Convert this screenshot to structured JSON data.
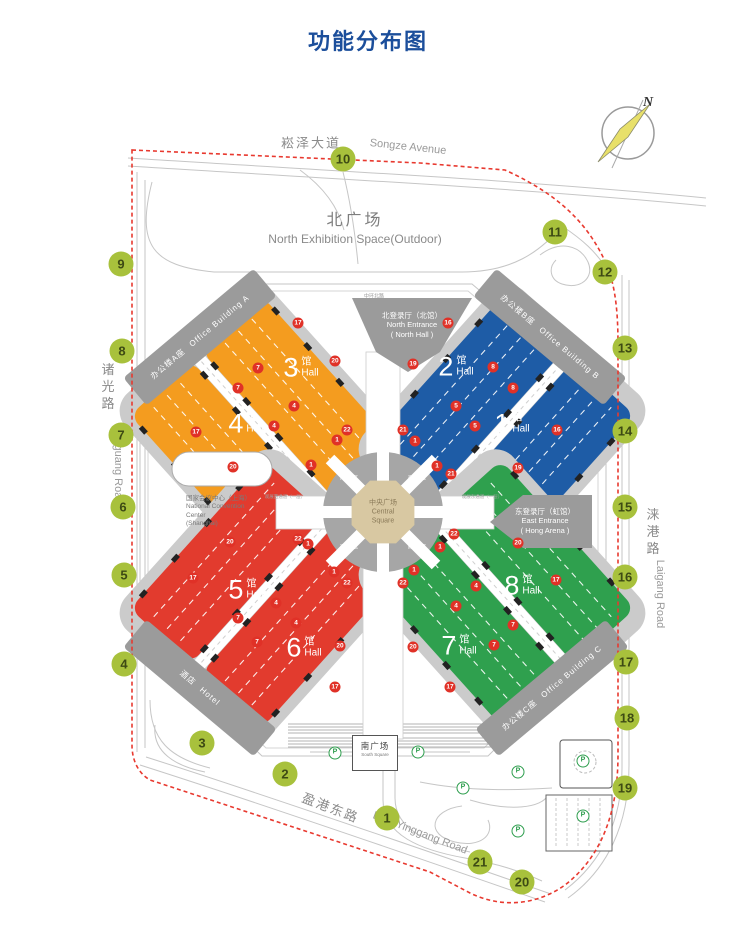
{
  "title": "功能分布图",
  "compass": {
    "label": "N"
  },
  "roads": {
    "songze_cn": "崧泽大道",
    "songze_en": "Songze Avenue",
    "zhuguang_cn": "诸光路",
    "zhuguang_en": "Zhuguang Road",
    "laigang_cn": "涞港路",
    "laigang_en": "Laigang Road",
    "yinggang_cn": "盈港东路",
    "yinggang_en": "East Yinggang Road",
    "zhonghuan_north": "中环北路",
    "corridor_west": "观展西通道（一层）",
    "corridor_east": "观展东通道（一层）"
  },
  "areas": {
    "north_plaza_cn": "北广场",
    "north_plaza_en": "North Exhibition Space(Outdoor)",
    "south_plaza_cn": "南广场",
    "south_plaza_en": "South Square",
    "central_cn": "中央广场",
    "central_en1": "Central",
    "central_en2": "Square",
    "north_entrance_cn": "北登录厅（北馆）",
    "north_entrance_en1": "North Entrance",
    "north_entrance_en2": "( North Hall )",
    "east_entrance_cn": "东登录厅（虹馆）",
    "east_entrance_en1": "East Entrance",
    "east_entrance_en2": "( Hong Arena )",
    "ncc_cn": "国家会议中心（上海）",
    "ncc_en1": "National Convention",
    "ncc_en2": "Center",
    "ncc_en3": "(Shanghai)",
    "office_a_cn": "办公楼A座",
    "office_a_en": "Office Building A",
    "office_b_cn": "办公楼B座",
    "office_b_en": "Office Building B",
    "office_c_cn": "办公楼C座",
    "office_c_en": "Office Building C",
    "hotel_cn": "酒店",
    "hotel_en": "Hotel",
    "plaza_a": "商业A区",
    "plaza_b": "商业B区",
    "plaza_c": "商业C区",
    "plaza_d": "商业D区"
  },
  "halls": [
    {
      "num": "1",
      "suffix": "馆",
      "sub": "Hall"
    },
    {
      "num": "2",
      "suffix": "馆",
      "sub": "Hall"
    },
    {
      "num": "3",
      "suffix": "馆",
      "sub": "Hall"
    },
    {
      "num": "4",
      "suffix": "馆",
      "sub": "Hall"
    },
    {
      "num": "5",
      "suffix": "馆",
      "sub": "Hall"
    },
    {
      "num": "6",
      "suffix": "馆",
      "sub": "Hall"
    },
    {
      "num": "7",
      "suffix": "馆",
      "sub": "Hall"
    },
    {
      "num": "8",
      "suffix": "馆",
      "sub": "Hall"
    }
  ],
  "markers": [
    {
      "label": "1",
      "x": 387,
      "y": 818
    },
    {
      "label": "2",
      "x": 285,
      "y": 774
    },
    {
      "label": "3",
      "x": 202,
      "y": 743
    },
    {
      "label": "4",
      "x": 124,
      "y": 664
    },
    {
      "label": "5",
      "x": 124,
      "y": 575
    },
    {
      "label": "6",
      "x": 123,
      "y": 507
    },
    {
      "label": "7",
      "x": 121,
      "y": 435
    },
    {
      "label": "8",
      "x": 122,
      "y": 351
    },
    {
      "label": "9",
      "x": 121,
      "y": 264
    },
    {
      "label": "10",
      "x": 343,
      "y": 159
    },
    {
      "label": "11",
      "x": 555,
      "y": 232
    },
    {
      "label": "12",
      "x": 605,
      "y": 272
    },
    {
      "label": "13",
      "x": 625,
      "y": 348
    },
    {
      "label": "14",
      "x": 625,
      "y": 431
    },
    {
      "label": "15",
      "x": 625,
      "y": 507
    },
    {
      "label": "16",
      "x": 625,
      "y": 577
    },
    {
      "label": "17",
      "x": 626,
      "y": 662
    },
    {
      "label": "18",
      "x": 627,
      "y": 718
    },
    {
      "label": "19",
      "x": 625,
      "y": 788
    },
    {
      "label": "20",
      "x": 522,
      "y": 882
    },
    {
      "label": "21",
      "x": 480,
      "y": 862
    }
  ],
  "gates": [
    {
      "label": "17",
      "x": 298,
      "y": 323
    },
    {
      "label": "20",
      "x": 335,
      "y": 361
    },
    {
      "label": "7",
      "x": 258,
      "y": 368
    },
    {
      "label": "7",
      "x": 238,
      "y": 388
    },
    {
      "label": "4",
      "x": 294,
      "y": 406
    },
    {
      "label": "4",
      "x": 274,
      "y": 426
    },
    {
      "label": "17",
      "x": 196,
      "y": 432
    },
    {
      "label": "20",
      "x": 233,
      "y": 467
    },
    {
      "label": "22",
      "x": 347,
      "y": 430
    },
    {
      "label": "1",
      "x": 337,
      "y": 440
    },
    {
      "label": "1",
      "x": 311,
      "y": 465
    },
    {
      "label": "16",
      "x": 448,
      "y": 323
    },
    {
      "label": "19",
      "x": 413,
      "y": 364
    },
    {
      "label": "8",
      "x": 493,
      "y": 367
    },
    {
      "label": "8",
      "x": 513,
      "y": 388
    },
    {
      "label": "5",
      "x": 456,
      "y": 406
    },
    {
      "label": "5",
      "x": 475,
      "y": 426
    },
    {
      "label": "16",
      "x": 557,
      "y": 430
    },
    {
      "label": "19",
      "x": 518,
      "y": 468
    },
    {
      "label": "21",
      "x": 403,
      "y": 430
    },
    {
      "label": "1",
      "x": 415,
      "y": 441
    },
    {
      "label": "1",
      "x": 437,
      "y": 466
    },
    {
      "label": "21",
      "x": 451,
      "y": 474
    },
    {
      "label": "20",
      "x": 230,
      "y": 542
    },
    {
      "label": "22",
      "x": 298,
      "y": 539
    },
    {
      "label": "1",
      "x": 308,
      "y": 544
    },
    {
      "label": "17",
      "x": 193,
      "y": 578
    },
    {
      "label": "4",
      "x": 276,
      "y": 603
    },
    {
      "label": "7",
      "x": 238,
      "y": 618
    },
    {
      "label": "4",
      "x": 296,
      "y": 623
    },
    {
      "label": "7",
      "x": 257,
      "y": 642
    },
    {
      "label": "1",
      "x": 334,
      "y": 572
    },
    {
      "label": "22",
      "x": 347,
      "y": 583
    },
    {
      "label": "20",
      "x": 340,
      "y": 646
    },
    {
      "label": "17",
      "x": 335,
      "y": 687
    },
    {
      "label": "22",
      "x": 454,
      "y": 534
    },
    {
      "label": "1",
      "x": 440,
      "y": 547
    },
    {
      "label": "20",
      "x": 518,
      "y": 543
    },
    {
      "label": "1",
      "x": 414,
      "y": 570
    },
    {
      "label": "22",
      "x": 403,
      "y": 583
    },
    {
      "label": "17",
      "x": 556,
      "y": 580
    },
    {
      "label": "4",
      "x": 476,
      "y": 586
    },
    {
      "label": "4",
      "x": 456,
      "y": 606
    },
    {
      "label": "7",
      "x": 513,
      "y": 625
    },
    {
      "label": "7",
      "x": 494,
      "y": 645
    },
    {
      "label": "20",
      "x": 413,
      "y": 647
    },
    {
      "label": "17",
      "x": 450,
      "y": 687
    }
  ],
  "parking": [
    {
      "label": "P",
      "x": 335,
      "y": 753
    },
    {
      "label": "P",
      "x": 418,
      "y": 752
    },
    {
      "label": "P",
      "x": 463,
      "y": 788
    },
    {
      "label": "P",
      "x": 518,
      "y": 772
    },
    {
      "label": "P",
      "x": 518,
      "y": 831
    },
    {
      "label": "P",
      "x": 583,
      "y": 761
    },
    {
      "label": "P",
      "x": 583,
      "y": 816
    }
  ],
  "colors": {
    "title_blue": "#1b4e9b",
    "hall_orange": "#f49c1f",
    "hall_blue": "#1e5ca6",
    "hall_red": "#e23b2e",
    "hall_green": "#2fa04e",
    "marker_green": "#a8c13c",
    "gate_red": "#e03127",
    "boundary_red": "#e8392f",
    "building_gray": "#9b9b9b",
    "plaza_tan": "#d8c8a2"
  }
}
